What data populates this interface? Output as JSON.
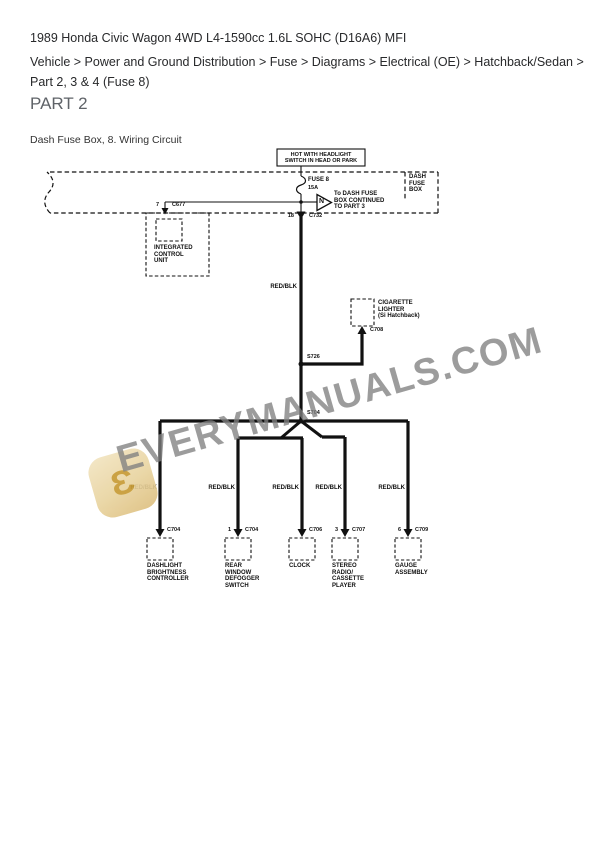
{
  "header": {
    "title": "1989 Honda Civic Wagon 4WD L4-1590cc 1.6L SOHC (D16A6) MFI",
    "breadcrumb": "Vehicle > Power and Ground Distribution > Fuse > Diagrams > Electrical (OE) > Hatchback/Sedan > Part 2, 3 & 4 (Fuse 8)",
    "part_title": "PART 2",
    "caption": "Dash Fuse Box, 8. Wiring Circuit"
  },
  "diagram": {
    "hot_box": "HOT  WITH  HEADLIGHT\nSWITCH IN HEAD OR PARK",
    "dash_fuse_box_label": "DASH\nFUSE\nBOX",
    "fuse_name": "FUSE 8",
    "fuse_rating": "15A",
    "arrow_letter": "N",
    "arrow_text": "To DASH FUSE\nBOX   CONTINUED\nTO PART 3",
    "icu_pin": "7",
    "icu_connector": "C677",
    "icu_name": "INTEGRATED\nCONTROL\nUNIT",
    "c732_pin": "18",
    "c732_connector": "C732",
    "main_wire_color": "RED/BLK",
    "splice_upper": "S726",
    "splice_lower": "S704",
    "lighter_name": "CIGARETTE\nLIGHTER\n(Si Hatchback)",
    "lighter_connector": "C708",
    "line_color": "#111111",
    "branches": [
      {
        "wire_color": "RED/BLK",
        "pin": "",
        "connector": "C704",
        "component": "DASHLIGHT\nBRIGHTNESS\nCONTROLLER"
      },
      {
        "wire_color": "RED/BLK",
        "pin": "1",
        "connector": "C704",
        "component": "REAR\nWINDOW\nDEFOGGER\nSWITCH"
      },
      {
        "wire_color": "RED/BLK",
        "pin": "",
        "connector": "C706",
        "component": "CLOCK"
      },
      {
        "wire_color": "RED/BLK",
        "pin": "3",
        "connector": "C707",
        "component": "STEREO\nRADIO/\nCASSETTE\nPLAYER"
      },
      {
        "wire_color": "RED/BLK",
        "pin": "6",
        "connector": "C709",
        "component": "GAUGE\nASSEMBLY"
      }
    ]
  },
  "watermark": {
    "text": "EVERYMANUALS.COM",
    "logo_glyph": "Ɛ"
  }
}
